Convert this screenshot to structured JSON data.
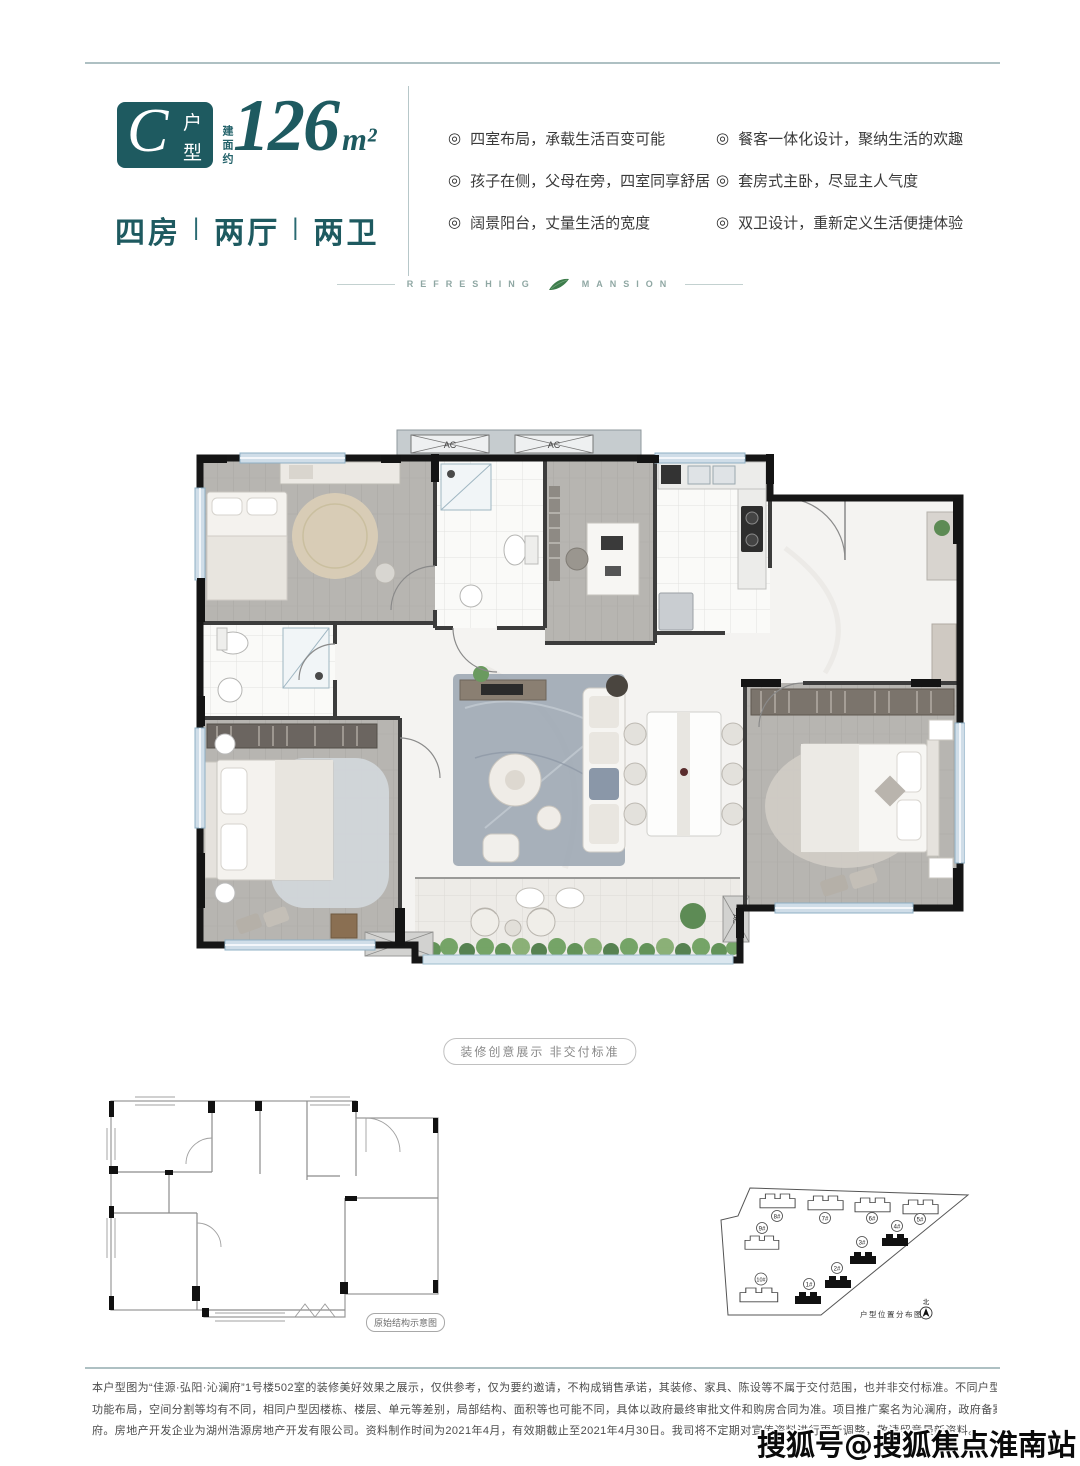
{
  "header": {
    "type_letter": "C",
    "type_char_top": "户",
    "type_char_bottom": "型",
    "area_prefix": "建面约",
    "area_value": "126",
    "area_unit": "m²",
    "rooms": [
      "四房",
      "两厅",
      "两卫"
    ],
    "separator": "|"
  },
  "features": {
    "bullet": "◎",
    "left": [
      "四室布局，承载生活百变可能",
      "孩子在侧，父母在旁，四室同享舒居",
      "阔景阳台，丈量生活的宽度"
    ],
    "right": [
      "餐客一体化设计，聚纳生活的欢趣",
      "套房式主卧，尽显主人气度",
      "双卫设计，重新定义生活便捷体验"
    ]
  },
  "brand": {
    "left_word": "REFRESHING",
    "right_word": "MANSION"
  },
  "floorplan": {
    "ac_label": "AC",
    "ac2_label": "2AC",
    "caption": "装修创意展示 非交付标准"
  },
  "structure_plan": {
    "caption": "原始结构示意图"
  },
  "siteplan": {
    "caption": "户型位置分布图",
    "north_label": "北",
    "buildings": [
      {
        "label": "1#",
        "highlight": true
      },
      {
        "label": "2#",
        "highlight": true
      },
      {
        "label": "3#",
        "highlight": true
      },
      {
        "label": "4#",
        "highlight": true
      },
      {
        "label": "5#",
        "highlight": false
      },
      {
        "label": "6#",
        "highlight": false
      },
      {
        "label": "7#",
        "highlight": false
      },
      {
        "label": "8#",
        "highlight": false
      },
      {
        "label": "9#",
        "highlight": false
      },
      {
        "label": "10#",
        "highlight": false
      }
    ]
  },
  "disclaimer": {
    "lines": [
      "本户型图为“佳源·弘阳·沁澜府”1号楼502室的装修美好效果之展示，仅供参考，仅为要约邀请，不构成销售承诺，其装修、家具、陈设等不属于交付范围，也并非交付标准。不同户型的面积尺寸，",
      "功能布局，空间分割等均有不同，相同户型因楼栋、楼层、单元等差别，局部结构、面积等也可能不同，具体以政府最终审批文件和购房合同为准。项目推广案名为沁澜府，政府备案核准名为沁澜",
      "府。房地产开发企业为湖州浩源房地产开发有限公司。资料制作时间为2021年4月，有效期截止至2021年4月30日。我司将不定期对宣传资料进行更新调整，敬请留意最新资料。"
    ]
  },
  "watermark": "搜狐号@搜狐焦点淮南站",
  "colors": {
    "teal": "#1e5a60",
    "rule": "#aec0c3",
    "leaf": "#3d7c4b"
  }
}
